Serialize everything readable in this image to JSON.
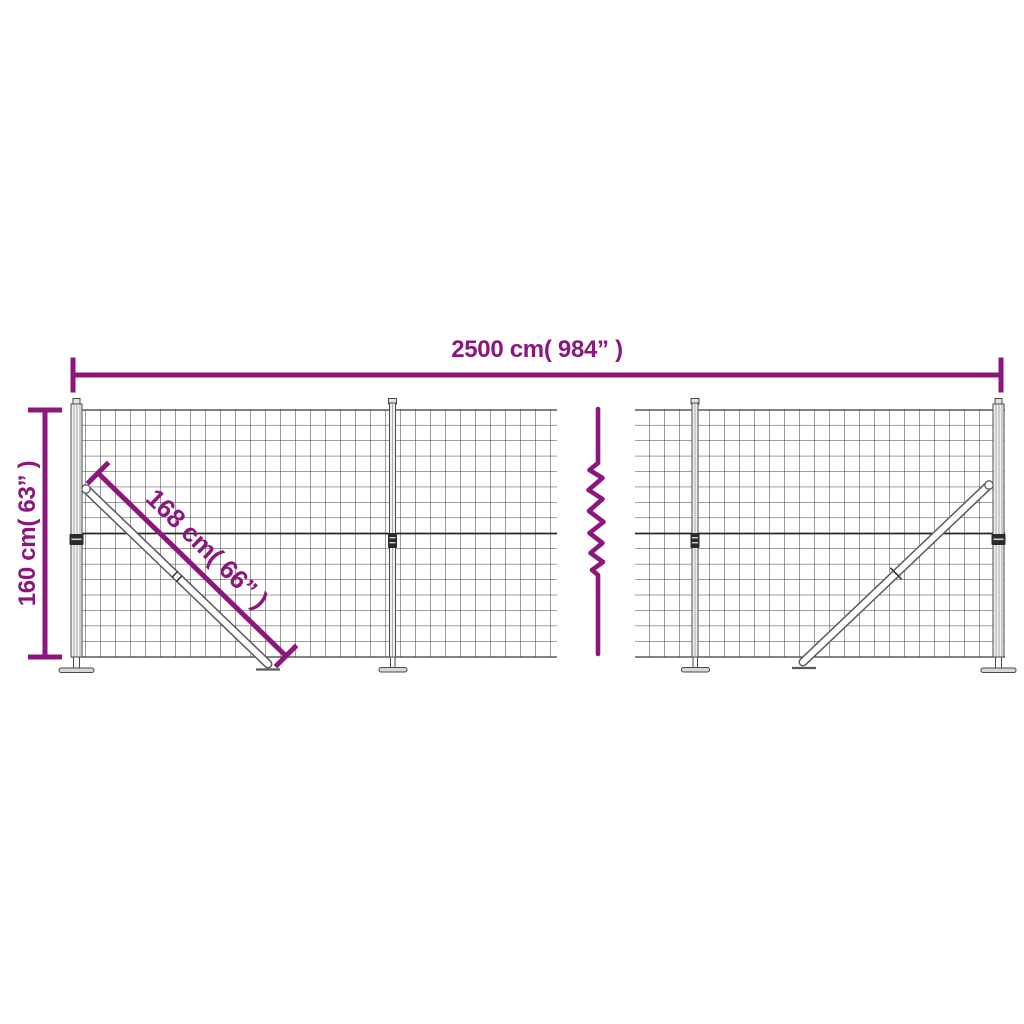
{
  "colors": {
    "accent": "#8B177C",
    "wire": "#3b3b3b",
    "background": "#ffffff"
  },
  "labels": {
    "width_label": "2500 cm( 984” )",
    "height_label": "160 cm( 63” )",
    "brace_label": "168 cm( 66” )"
  },
  "measurements": {
    "width_cm": 2500,
    "width_in": 984,
    "height_cm": 160,
    "height_in": 63,
    "brace_cm": 168,
    "brace_in": 66
  }
}
